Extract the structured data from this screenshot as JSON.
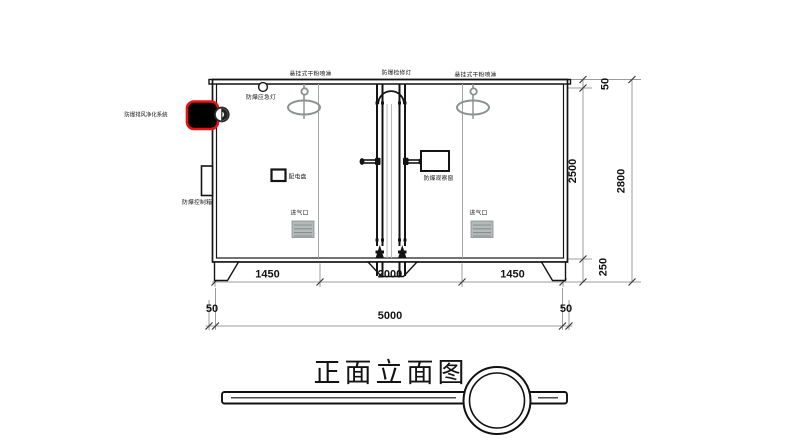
{
  "drawing": {
    "title": "正面立面图",
    "labels": {
      "sprinkler_left": "悬挂式干粉喷淋",
      "maintenance_light": "防爆检修灯",
      "sprinkler_right": "悬挂式干粉喷淋",
      "emergency_light": "防爆应急灯",
      "exhaust_purification_system": "防爆排风净化系统",
      "control_box": "防爆控制箱",
      "distribution_panel": "配电盘",
      "observation_window": "防爆观察窗",
      "air_inlet_left": "进气口",
      "air_inlet_right": "进气口"
    },
    "dims": {
      "bottom_left_span": "1450",
      "bottom_center_span": "2000",
      "bottom_right_span": "1450",
      "bottom_offset_left": "50",
      "bottom_total": "5000",
      "bottom_offset_right": "50",
      "side_roof": "50",
      "side_body": "2500",
      "side_base": "250",
      "side_total": "2800"
    },
    "colors": {
      "dimension": "#f10000",
      "highlight": "#ee0f0f",
      "line": "#141414",
      "device_grey": "#8d9292"
    }
  }
}
